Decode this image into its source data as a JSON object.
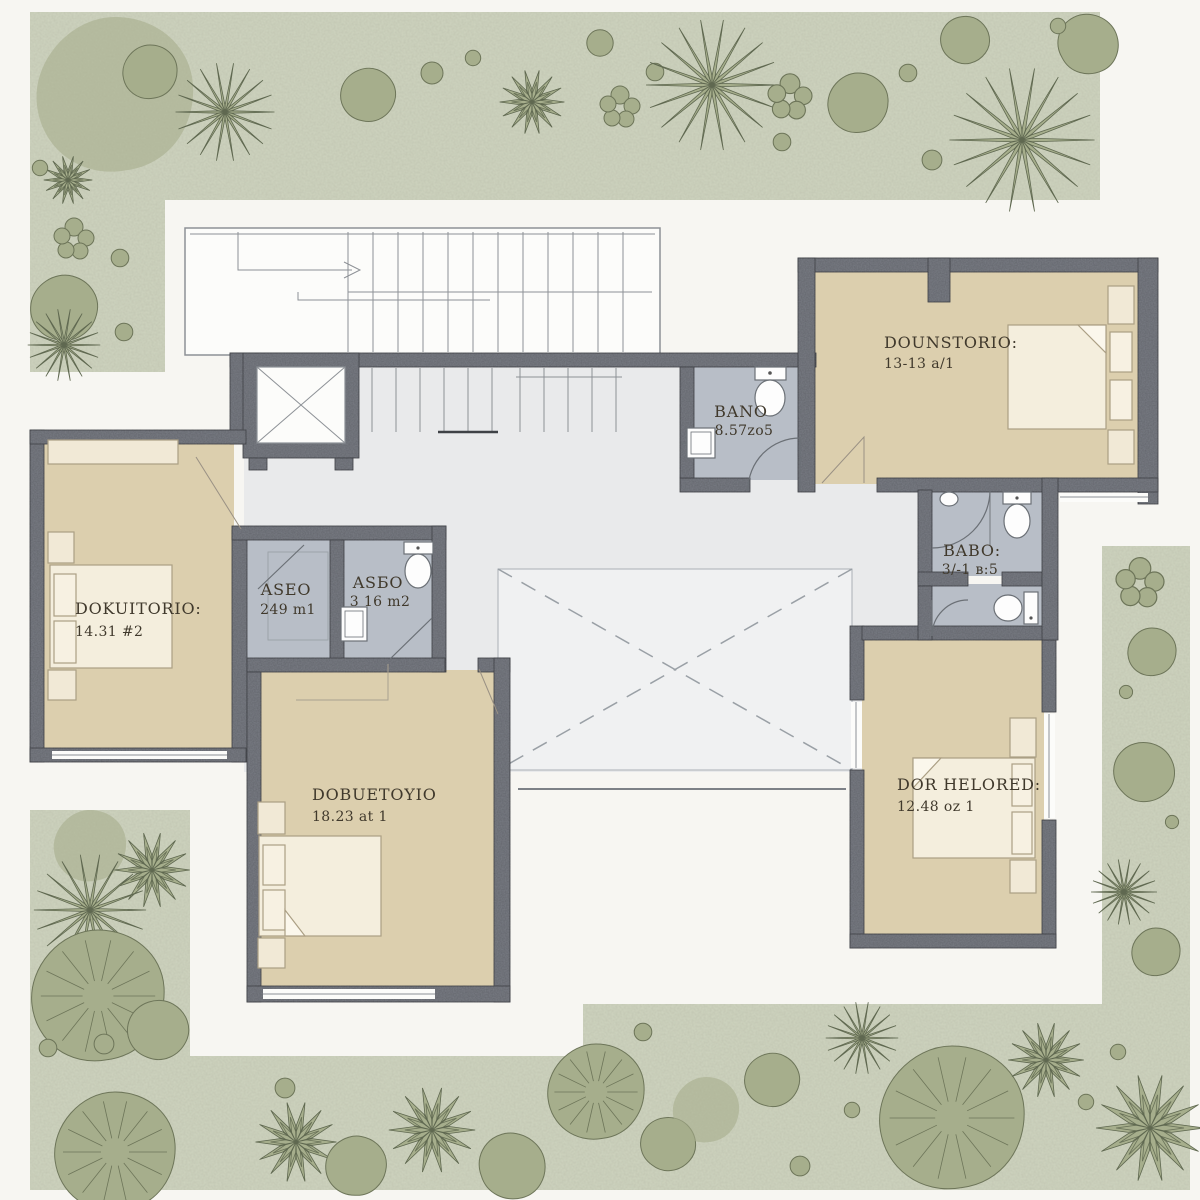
{
  "plan": {
    "type": "floor-plan",
    "rooms": [
      {
        "id": "dormitorio-top-right",
        "name": "DOUNSTORIO:",
        "area": "13-13 a/1"
      },
      {
        "id": "bano-top",
        "name": "BANO",
        "area": "8.57zo5"
      },
      {
        "id": "dormitorio-left",
        "name": "DOKUITORIO:",
        "area": "14.31 #2"
      },
      {
        "id": "aseo-1",
        "name": "ASEO",
        "area": "249 m1"
      },
      {
        "id": "aseo-2",
        "name": "ASБO",
        "area": "3 16 m2"
      },
      {
        "id": "bano-right",
        "name": "BABO:",
        "area": "3/-1 в:5"
      },
      {
        "id": "dormitorio-bottom",
        "name": "DOBUETOYIO",
        "area": "18.23 at 1"
      },
      {
        "id": "dormitorio-bottom-right",
        "name": "DOR HELORED:",
        "area": "12.48 oz 1"
      }
    ],
    "palette": {
      "background": "#f7f6f2",
      "garden": "#cfd4bf",
      "plant": "#a6ae8c",
      "plant_soft": "#9aa383",
      "wall": "#797c84",
      "room_beige": "#dccfae",
      "bath_gray": "#b8bec7",
      "hall_gray": "#e9eaeb",
      "void_fill": "#f0f1f2",
      "furniture_cream": "#f4eedd",
      "line": "#8d9196",
      "text": "#40392c"
    }
  }
}
